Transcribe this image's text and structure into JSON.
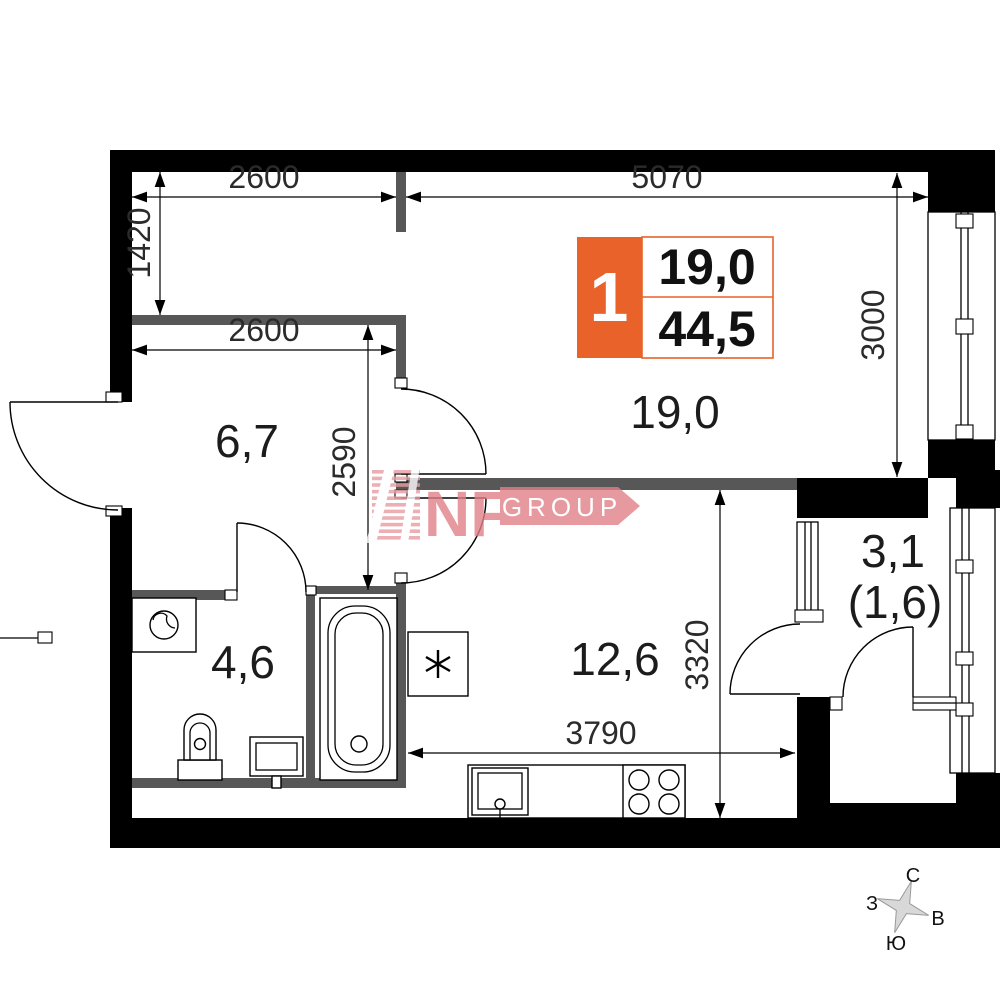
{
  "plan": {
    "unit_info": {
      "number": "1",
      "living_area": "19,0",
      "total_area": "44,5"
    },
    "rooms": {
      "living": "19,0",
      "hall": "6,7",
      "bathroom": "4,6",
      "kitchen": "12,6",
      "balcony": "3,1",
      "balcony_reduced": "(1,6)"
    },
    "dimensions": {
      "alcove_width": "2600",
      "living_width": "5070",
      "alcove_height": "1420",
      "hall_width": "2600",
      "hall_height": "2590",
      "window_side": "3000",
      "kitchen_height": "3320",
      "kitchen_width": "3790"
    },
    "compass": {
      "north": "С",
      "east": "В",
      "south": "Ю",
      "west": "З"
    },
    "watermark": {
      "brand": "NF",
      "suffix": "GROUP"
    },
    "colors": {
      "accent_orange": "#E8622A",
      "watermark_pink": "#E08188",
      "wall_black": "#000000",
      "wall_gray": "#575757"
    }
  }
}
